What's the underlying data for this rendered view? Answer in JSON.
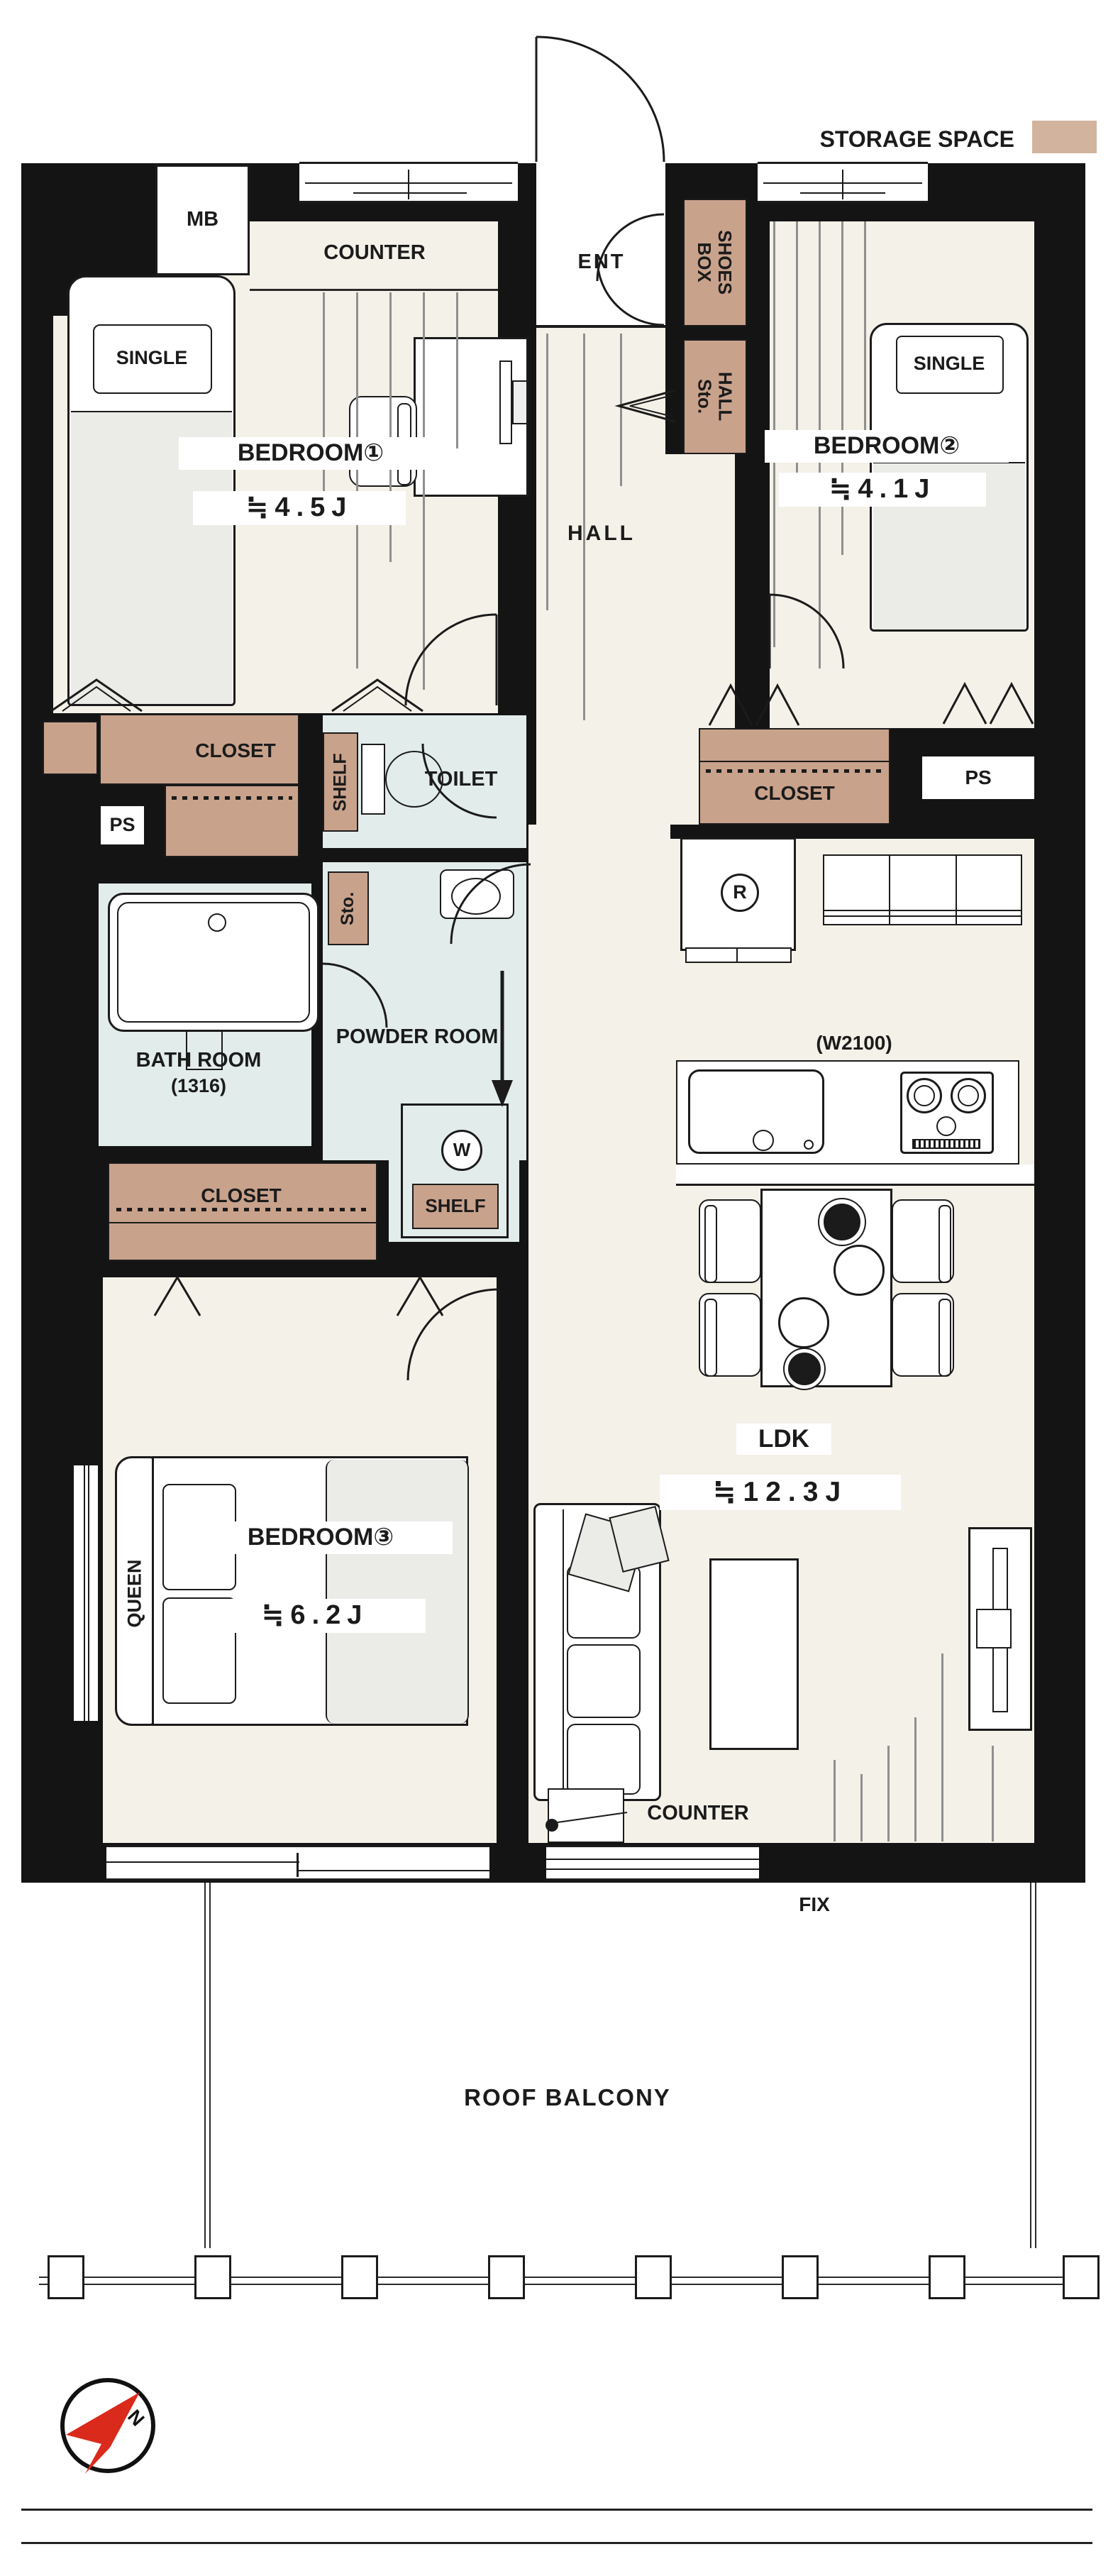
{
  "legend": {
    "storage_space_label": "STORAGE SPACE"
  },
  "rooms": {
    "bedroom1": {
      "name": "BEDROOM①",
      "area": "≒4.5J"
    },
    "bedroom2": {
      "name": "BEDROOM②",
      "area": "≒4.1J"
    },
    "bedroom3": {
      "name": "BEDROOM③",
      "area": "≒6.2J"
    },
    "ldk": {
      "name": "LDK",
      "area": "≒12.3J"
    },
    "hall": {
      "name": "HALL"
    },
    "ent": {
      "name": "ENT"
    },
    "toilet": {
      "name": "TOILET"
    },
    "bathroom": {
      "name": "BATH ROOM",
      "size": "(1316)"
    },
    "powder_room": {
      "name": "POWDER ROOM"
    }
  },
  "fixtures": {
    "meter_box": "MB",
    "counter_top": "COUNTER",
    "counter_ldk": "COUNTER",
    "shoes_box": "SHOES BOX",
    "hall_storage": "HALL Sto.",
    "storage_small": "Sto.",
    "shelf_toilet": "SHELF",
    "shelf_powder": "SHELF",
    "closet_bedroom1": "CLOSET",
    "closet_bedroom2": "CLOSET",
    "closet_bedroom3": "CLOSET",
    "pipe_space_left": "PS",
    "pipe_space_right": "PS",
    "washer": "W",
    "refrigerator": "R",
    "kitchen_width": "(W2100)",
    "bed_single_1": "SINGLE",
    "bed_single_2": "SINGLE",
    "bed_queen": "QUEEN"
  },
  "balcony": {
    "name": "ROOF BALCONY",
    "fix_window": "FIX"
  },
  "compass": {
    "north": "N"
  },
  "colors": {
    "wall": "#141414",
    "floor": "#f4f1e8",
    "wet_area": "#e2eceb",
    "storage": "#c9a28c",
    "legend_swatch": "#d2b49e",
    "compass_red": "#da2a1c"
  }
}
